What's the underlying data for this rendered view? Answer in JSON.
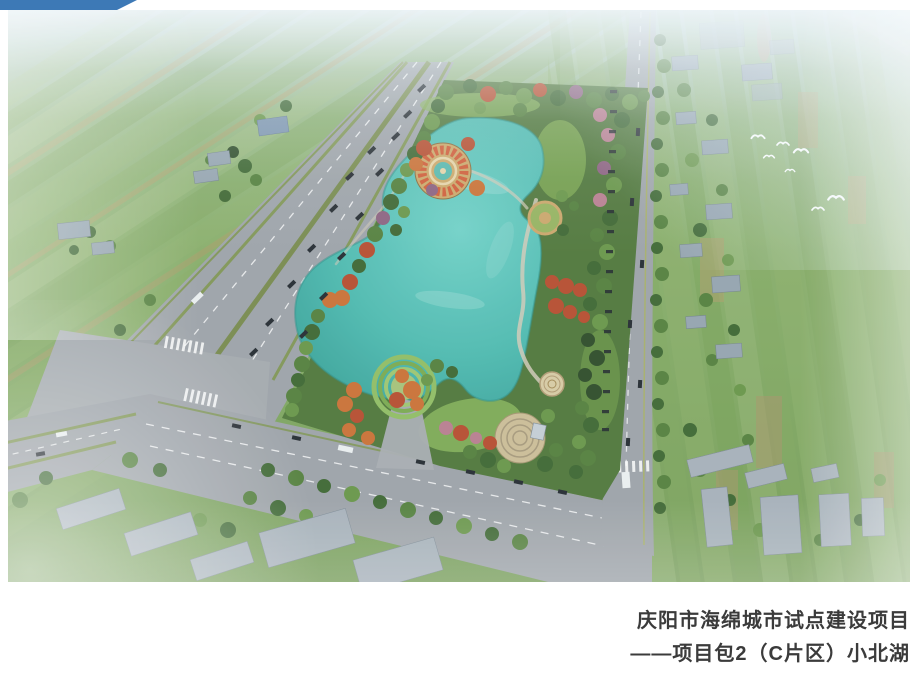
{
  "slide": {
    "corner_accent_color": "#3d79b6",
    "caption": {
      "line1": "庆阳市海绵城市试点建设项目",
      "line2": "——项目包2（C片区）小北湖",
      "text_color": "#3b3b3b"
    },
    "render": {
      "alt": "Aerial rendering of the planned Xiaobei Lake park: a turquoise gourd-shaped lake ringed by green and autumn-red trees with circular plazas, a diagonal tree-lined boulevard on the left, a vertical road on the right, surrounding patchwork farmland, village buildings and white egrets, fading into haze at the top",
      "palette": {
        "lake_light": "#6fd0c6",
        "lake_deep": "#339c93",
        "field_green": "#83aa64",
        "park_green": "#4e7539",
        "autumn_red": "#b54b2d",
        "road_gray": "#9ca1a7",
        "median_green": "#7f9454",
        "building_gray": "#97a4af",
        "haze_white": "#edf4f8"
      }
    }
  }
}
